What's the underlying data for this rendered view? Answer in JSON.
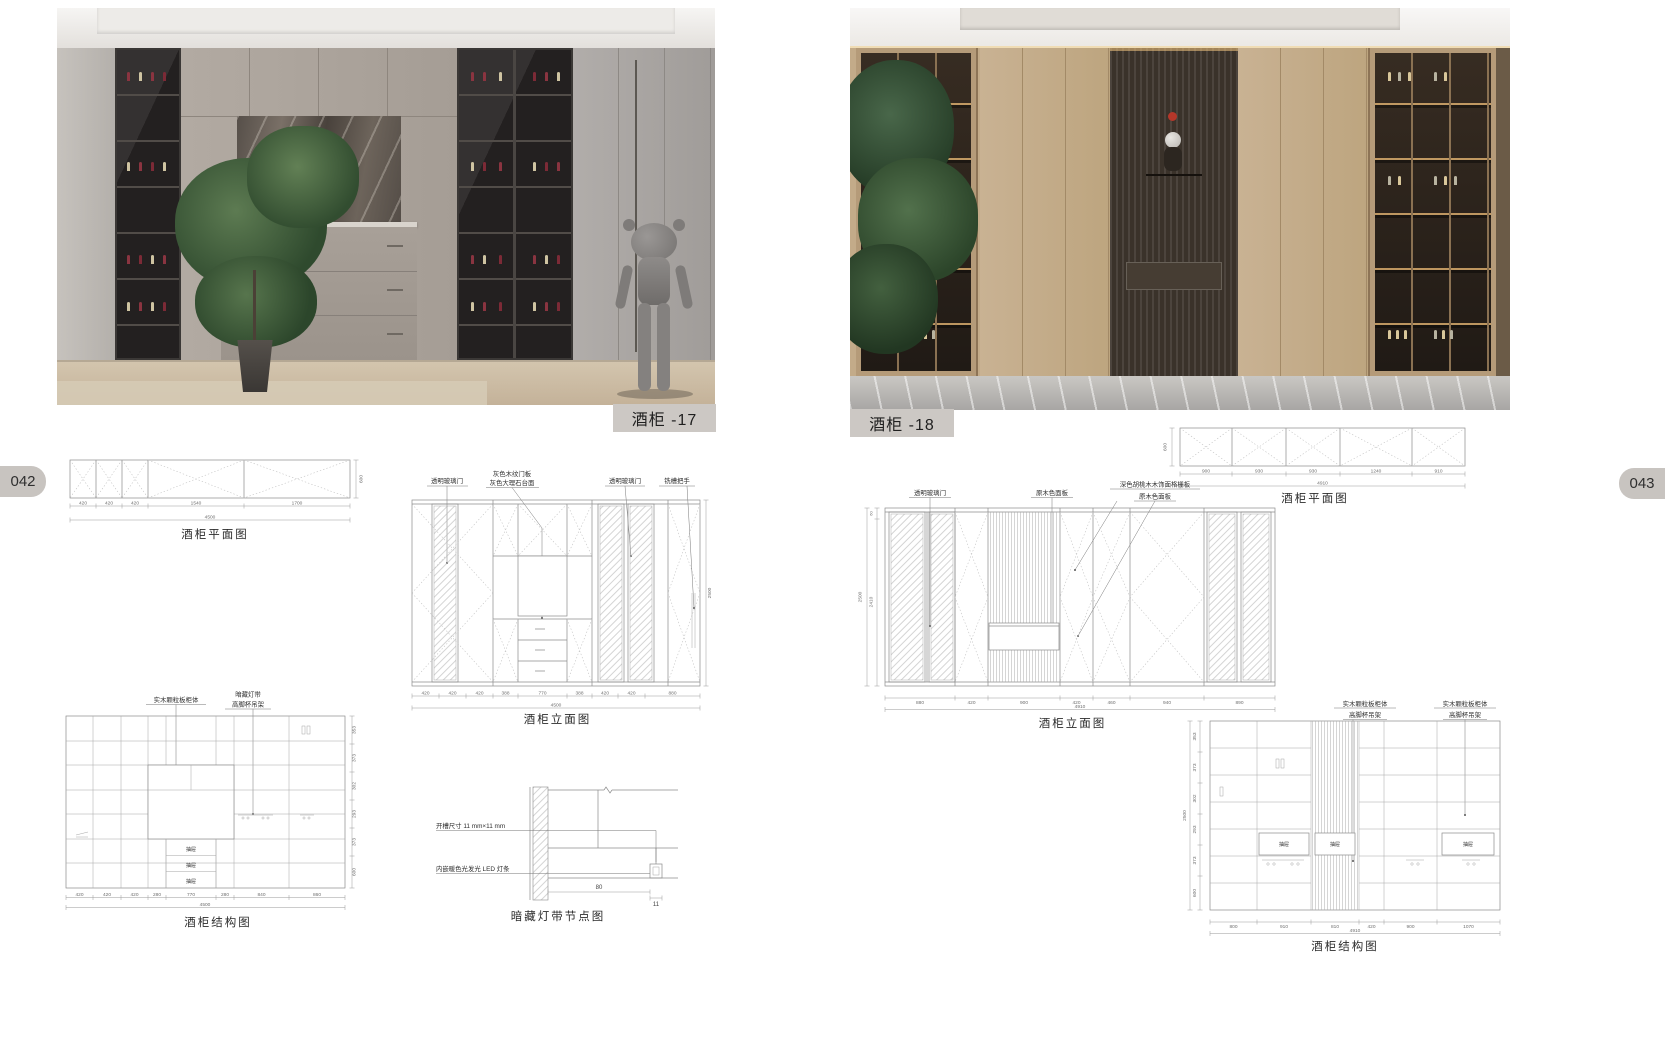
{
  "left_page": {
    "page_number": "042",
    "photo_caption": "酒柜 -17",
    "plan": {
      "title": "酒柜平面图",
      "depth": "600",
      "dims": [
        "420",
        "420",
        "420",
        "1540",
        "1700"
      ],
      "total": "4500"
    },
    "elevation": {
      "title": "酒柜立面图",
      "height_total": "2500",
      "label_glass_left": "透明玻璃门",
      "label_door_panel": "灰色木纹门板",
      "label_countertop": "灰色大理石台面",
      "label_glass_right": "透明玻璃门",
      "label_handle": "铣槽把手",
      "dims": [
        "420",
        "420",
        "420",
        "388",
        "770",
        "388",
        "420",
        "420",
        "880"
      ],
      "total": "4500"
    },
    "structure": {
      "title": "酒柜结构图",
      "label_cabinet_body": "实木颗粒板柜体",
      "label_hidden_light": "暗藏灯带",
      "label_goblet_rack": "高脚杯吊架",
      "drawer_label": "抽屉",
      "dims": [
        "420",
        "420",
        "420",
        "280",
        "770",
        "280",
        "840",
        "860"
      ],
      "total": "4500",
      "side_dims": [
        "353",
        "373",
        "302",
        "293",
        "373",
        "600"
      ],
      "side_total": "2500"
    },
    "node_detail": {
      "title": "暗藏灯带节点图",
      "label_groove": "开槽尺寸 11 mm×11 mm",
      "label_led": "内嵌暖色光发光 LED 灯条",
      "dim_width": "80",
      "dim_depth": "11"
    }
  },
  "right_page": {
    "page_number": "043",
    "photo_caption": "酒柜 -18",
    "plan": {
      "title": "酒柜平面图",
      "depth": "600",
      "dims": [
        "900",
        "930",
        "930",
        "1240",
        "910"
      ],
      "total": "4910"
    },
    "elevation": {
      "title": "酒柜立面图",
      "height_top": "60",
      "height_mid": "2410",
      "height_total": "2500",
      "label_glass": "透明玻璃门",
      "label_wood_panel": "原木色面板",
      "label_grille": "深色胡桃木木饰面格栅板",
      "label_wood_panel2": "原木色面板",
      "dims": [
        "880",
        "420",
        "900",
        "420",
        "460",
        "940",
        "890"
      ],
      "total": "4910"
    },
    "structure": {
      "title": "酒柜结构图",
      "label_cabinet_body": "实木颗粒板柜体",
      "label_goblet_rack": "高脚杯吊架",
      "label_cabinet_body2": "实木颗粒板柜体",
      "label_goblet_rack2": "高脚杯吊架",
      "drawer_label": "抽屉",
      "dims": [
        "800",
        "910",
        "810",
        "420",
        "900",
        "1070"
      ],
      "total": "4910",
      "side_dims": [
        "353",
        "373",
        "302",
        "293",
        "373",
        "600"
      ],
      "side_total": "2500"
    }
  }
}
